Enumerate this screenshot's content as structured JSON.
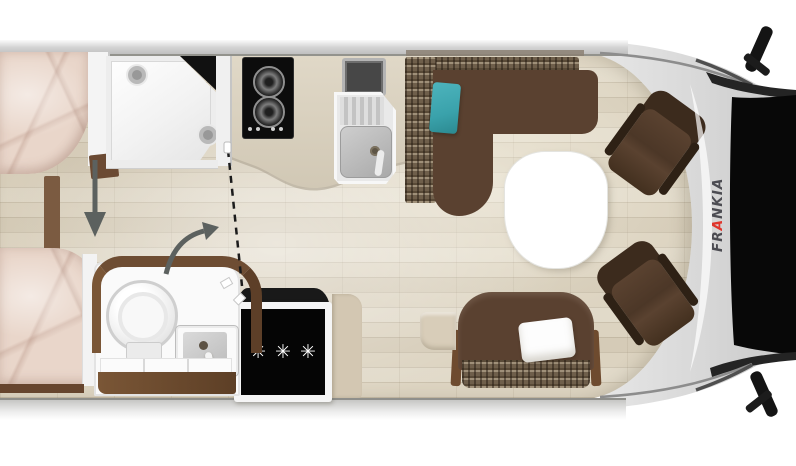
{
  "title": "Motorhome floor plan (top view)",
  "brand": {
    "part1": "FR",
    "accent": "A",
    "part2": "NKIA",
    "full": "FRANKIA"
  },
  "appliances": {
    "freezer_symbols": "✳✳✳"
  },
  "colors": {
    "background": "#ffffff",
    "wall_gray": "#d4d4d4",
    "floor_wood": "#dcd3c0",
    "counter_beige": "#d8d0bf",
    "sofa_brown": "#5a4130",
    "tweed_brown": "#6f5f4b",
    "cushion_teal": "#3fa9b0",
    "bedding_rose": "#e8d4c9",
    "cabinet_wood": "#6e4d33",
    "appliance_black": "#0a0a0a",
    "brand_red": "#e0352b",
    "arrow_gray": "#5c615f"
  },
  "elements": {
    "rooms": [
      "rear-bedroom",
      "bathroom",
      "kitchen",
      "dinette",
      "cab"
    ],
    "furniture": [
      "rear-bed-top",
      "rear-bed-bottom",
      "shower",
      "gas-hob",
      "kitchen-sink",
      "refrigerator",
      "toilet",
      "washbasin",
      "dinette-sofa",
      "dinette-table",
      "front-bench",
      "cab-seat-passenger",
      "cab-seat-driver"
    ],
    "indicators": [
      "bed-direction-arrow",
      "door-swing-arrow",
      "sliding-door-dashed-line"
    ]
  }
}
